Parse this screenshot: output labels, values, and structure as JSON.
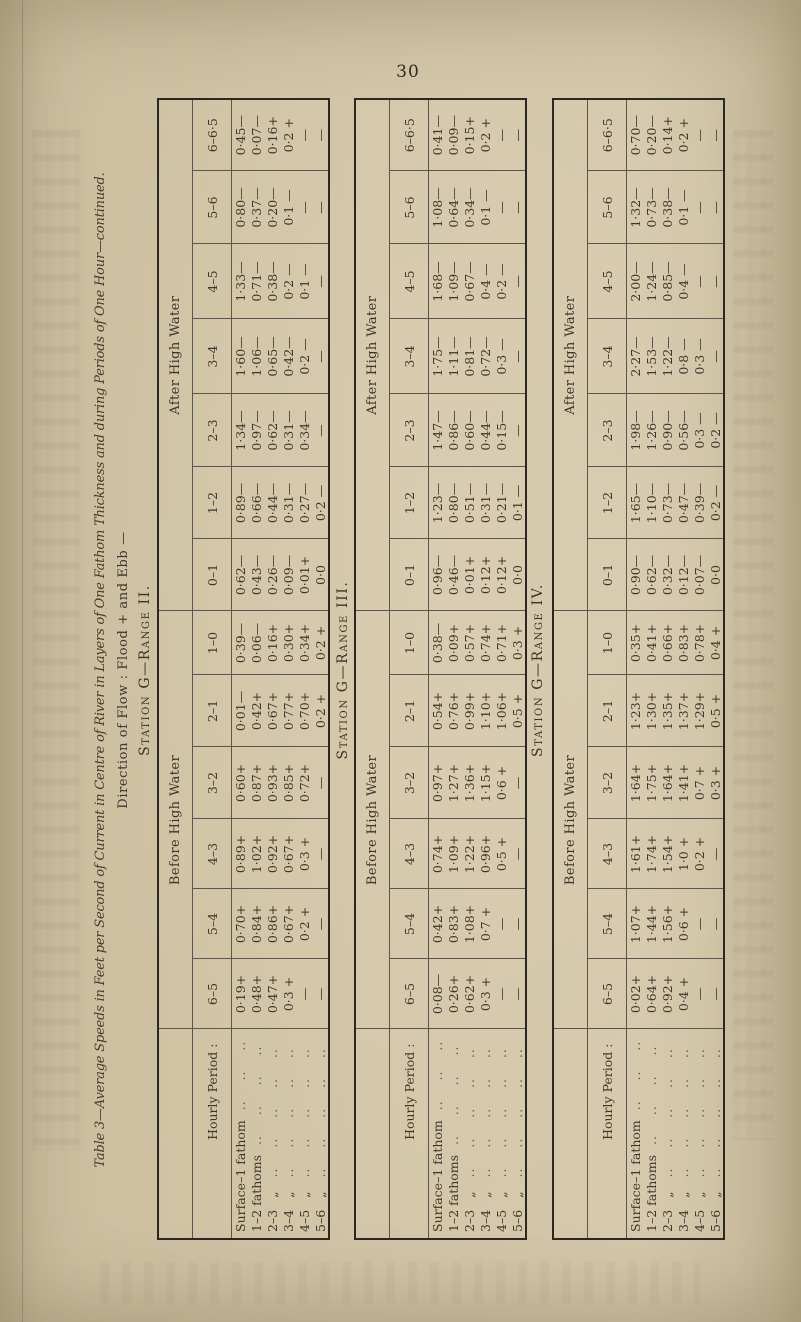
{
  "page": {
    "number": "30"
  },
  "title": {
    "line1": "Table 3—Average Speeds in Feet per Second of Current in Centre of River in Layers of One Fathom Thickness and during Periods of One Hour—continued.",
    "line2": "Direction of Flow :  Flood +  and Ebb —"
  },
  "header": {
    "row_axis_label": "Hourly Period :",
    "groups": [
      {
        "label": "Before High Water",
        "span": 6
      },
      {
        "label": "After High Water",
        "span": 7
      }
    ],
    "columns": [
      "6–5",
      "5–4",
      "4–3",
      "3–2",
      "2–1",
      "1–0",
      "0–1",
      "1–2",
      "2–3",
      "3–4",
      "4–5",
      "5–6",
      "6–6·5"
    ]
  },
  "row_labels": [
    {
      "main": "Surface–1 fathom",
      "ditto": ""
    },
    {
      "main": "1–2 fathoms",
      "ditto": ""
    },
    {
      "main": "2–3",
      "ditto": "„"
    },
    {
      "main": "3–4",
      "ditto": "„"
    },
    {
      "main": "4–5",
      "ditto": "„"
    },
    {
      "main": "5–6",
      "ditto": "„"
    }
  ],
  "stations": [
    {
      "caption": "Station G—Range II.",
      "rows": [
        [
          "0·19+",
          "0·70+",
          "0·89+",
          "0·60+",
          "0·01—",
          "0·39—",
          "0·62—",
          "0·89—",
          "1·34—",
          "1·60—",
          "1·33—",
          "0·80—",
          "0·45—"
        ],
        [
          "0·48+",
          "0·84+",
          "1·02+",
          "0·87+",
          "0·42+",
          "0·06—",
          "0·43—",
          "0·66—",
          "0·97—",
          "1·06—",
          "0·71—",
          "0·37—",
          "0·07—"
        ],
        [
          "0·47+",
          "0·86+",
          "0·92+",
          "0·93+",
          "0·67+",
          "0·16+",
          "0·26—",
          "0·44—",
          "0·62—",
          "0·65—",
          "0·38—",
          "0·20—",
          "0·16+"
        ],
        [
          "0·3 +",
          "0·67+",
          "0·67+",
          "0·85+",
          "0·77+",
          "0·30+",
          "0·09—",
          "0·31—",
          "0·31—",
          "0·42—",
          "0·2 —",
          "0·1 —",
          "0·2 +"
        ],
        [
          "—",
          "0·2 +",
          "0·3 +",
          "0·72+",
          "0·70+",
          "0·34+",
          "0·01+",
          "0·27—",
          "0·34—",
          "0·2 —",
          "0·1 —",
          "—",
          "—"
        ],
        [
          "—",
          "—",
          "—",
          "—",
          "0·2 +",
          "0·2 +",
          "0·0",
          "0·2 —",
          "—",
          "—",
          "—",
          "—",
          "—"
        ]
      ]
    },
    {
      "caption": "Station G—Range III.",
      "rows": [
        [
          "0·08—",
          "0·42+",
          "0·74+",
          "0·97+",
          "0·54+",
          "0·38—",
          "0·96—",
          "1·23—",
          "1·47—",
          "1·75—",
          "1·68—",
          "1·08—",
          "0·41—"
        ],
        [
          "0·26+",
          "0·83+",
          "1·09+",
          "1·27+",
          "0·76+",
          "0·09+",
          "0·46—",
          "0·80—",
          "0·86—",
          "1·11—",
          "1·09—",
          "0·64—",
          "0·09—"
        ],
        [
          "0·62+",
          "1·08+",
          "1·22+",
          "1·36+",
          "0·99+",
          "0·57+",
          "0·01+",
          "0·51—",
          "0·60—",
          "0·81—",
          "0·67—",
          "0·34—",
          "0·15+"
        ],
        [
          "0·3 +",
          "0·7 +",
          "0·96+",
          "1·15+",
          "1·10+",
          "0·74+",
          "0·12+",
          "0·31—",
          "0·44—",
          "0·72—",
          "0·4 —",
          "0·1 —",
          "0·2 +"
        ],
        [
          "—",
          "—",
          "0·5 +",
          "0·6 +",
          "1·06+",
          "0·71+",
          "0·12+",
          "0·21—",
          "0·15—",
          "0·3 —",
          "0·2 —",
          "—",
          "—"
        ],
        [
          "—",
          "—",
          "—",
          "—",
          "0·5 +",
          "0·3 +",
          "0·0",
          "0·1 —",
          "—",
          "—",
          "—",
          "—",
          "—"
        ]
      ]
    },
    {
      "caption": "Station G—Range IV.",
      "rows": [
        [
          "0·02+",
          "1·07+",
          "1·61+",
          "1·64+",
          "1·23+",
          "0·35+",
          "0·90—",
          "1·65—",
          "1·98—",
          "2·27—",
          "2·00—",
          "1·32—",
          "0·70—"
        ],
        [
          "0·64+",
          "1·44+",
          "1·74+",
          "1·75+",
          "1·30+",
          "0·41+",
          "0·62—",
          "1·10—",
          "1·26—",
          "1·53—",
          "1·24—",
          "0·73—",
          "0·20—"
        ],
        [
          "0·92+",
          "1·56+",
          "1·54+",
          "1·64+",
          "1·35+",
          "0·66+",
          "0·32—",
          "0·73—",
          "0·90—",
          "1·22—",
          "0·85—",
          "0·38—",
          "0·14+"
        ],
        [
          "0·4 +",
          "0·6 +",
          "1·0 +",
          "1·41+",
          "1·37+",
          "0·83+",
          "0·12—",
          "0·47—",
          "0·56—",
          "0·8 —",
          "0·4 —",
          "0·1 —",
          "0·2 +"
        ],
        [
          "—",
          "—",
          "0·2 +",
          "0·7 +",
          "1·29+",
          "0·78+",
          "0·07—",
          "0·39—",
          "0·3 —",
          "0·3 —",
          "—",
          "—",
          "—"
        ],
        [
          "—",
          "—",
          "—",
          "0·3 +",
          "0·5 +",
          "0·4 +",
          "0·0",
          "0·2 —",
          "0·2 —",
          "—",
          "—",
          "—",
          "—"
        ]
      ]
    }
  ]
}
